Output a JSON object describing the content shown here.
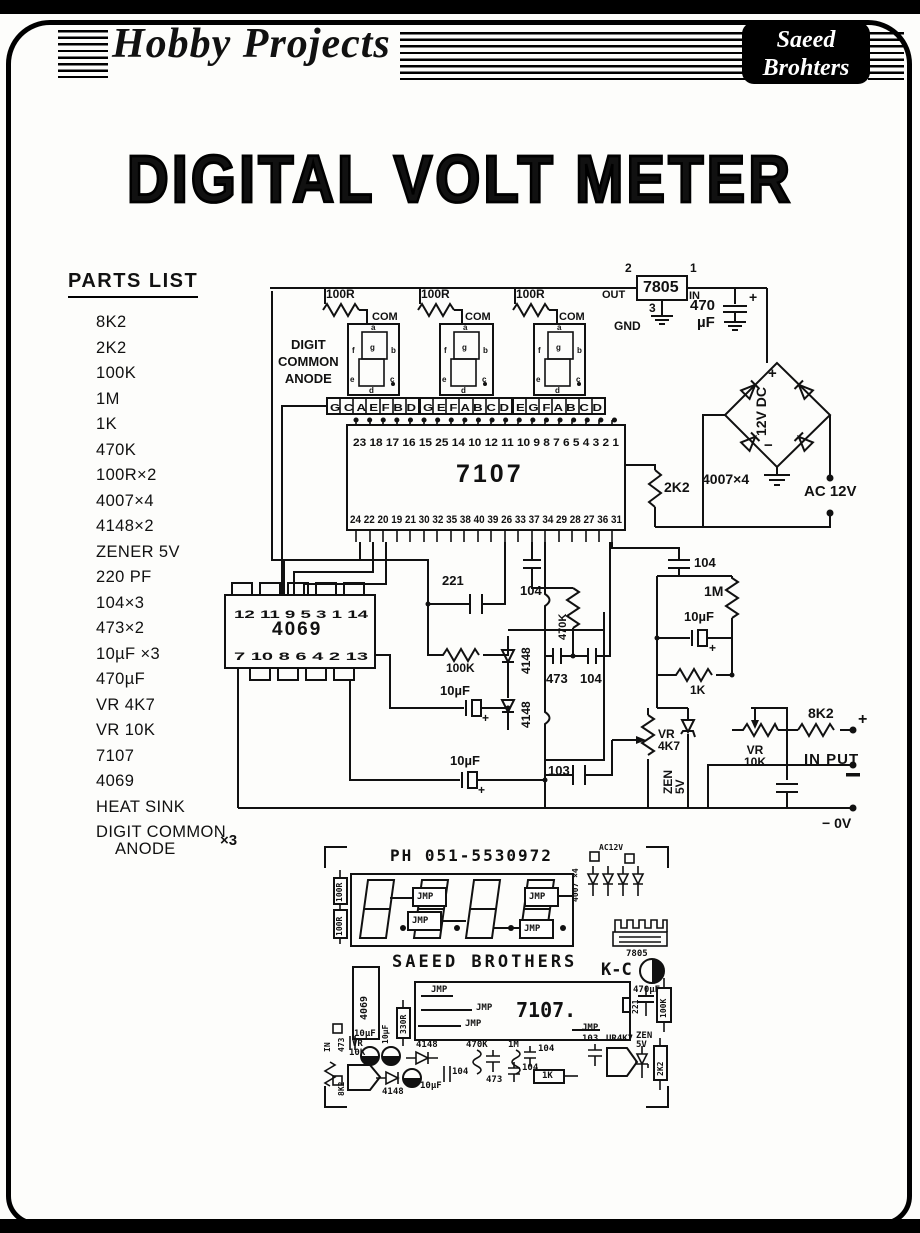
{
  "header": {
    "brand": "Hobby Projects",
    "badge": {
      "line1": "Saeed",
      "line2": "Brohters"
    }
  },
  "title": "DIGITAL VOLT METER",
  "parts_list": {
    "heading": "PARTS LIST",
    "items": [
      "8K2",
      "2K2",
      "100K",
      "1M",
      "1K",
      "470K",
      "100R×2",
      "4007×4",
      "4148×2",
      "ZENER 5V",
      "220 PF",
      "104×3",
      "473×2",
      "10µF ×3",
      "470µF",
      "VR 4K7",
      "VR 10K",
      "7107",
      "4069",
      "HEAT SINK",
      "DIGIT COMMON\n    ANODE"
    ],
    "anode_qty": "×3"
  },
  "schematic": {
    "digit_label": "DIGIT\nCOMMON\nANODE",
    "displays": [
      {
        "resistor": "100R",
        "com": "COM",
        "pins": "G C A E F B D"
      },
      {
        "resistor": "100R",
        "com": "COM",
        "pins": "G E F A B C D"
      },
      {
        "resistor": "100R",
        "com": "COM",
        "pins": "E G F A B C D"
      }
    ],
    "seg": {
      "a": "a",
      "b": "b",
      "c": "c",
      "d": "d",
      "e": "e",
      "f": "f",
      "g": "g"
    },
    "ic7107": {
      "name": "7107",
      "top_pins": "23 18 17 16 15 25 14 10 12 11 10 9 8 7 6 5 4 3 2 1",
      "bottom_pins": "24 22 20 19 21 30 32 35 38 40 39 26 33 37 34 29 28 27 36 31"
    },
    "reg": {
      "name": "7805",
      "p1": "1",
      "p2": "2",
      "p3": "3",
      "out": "OUT",
      "in": "IN",
      "gnd": "GND"
    },
    "sup": {
      "c470": "470",
      "uf": "µF",
      "plus": "+",
      "bridge": "4007×4",
      "dc": "12V DC",
      "bplus": "+",
      "bminus": "−",
      "ac": "AC 12V"
    },
    "r2k2": "2K2",
    "ic4069": {
      "name": "4069",
      "top_pins": "12 11 9 5 3 1 14",
      "bottom_pins": "7 10 8 6 4 2 13"
    },
    "c221": "221",
    "r100k": "100K",
    "c10uf": "10µF",
    "d4148": "4148",
    "c104": "104",
    "r470k": "470K",
    "c473": "473",
    "c103": "103",
    "r1m": "1M",
    "r1k": "1K",
    "vr4k7": "VR\n4K7",
    "zen": "ZEN\n5V",
    "vr10k": "VR\n10K",
    "r8k2": "8K2",
    "input": "IN PUT",
    "zero": "− 0V",
    "plus": "+"
  },
  "pcb": {
    "title": "PH 051-5530972",
    "brand": "SAEED BROTHERS",
    "jmp": "JMP",
    "r100r": "100R",
    "d4007": "4007 ×4",
    "ac": "AC12V",
    "reg": "7805",
    "kc": "K-C",
    "c470uf": "470µF",
    "ic4069": "4069",
    "ic7107": "7107.",
    "r330": "330R",
    "c221": "221",
    "r100k": "100K",
    "zen": "ZEN\n5V",
    "r2k2": "2K2",
    "c103": "103",
    "vr4k7": "UR4K7",
    "c104": "104",
    "r1k": "1K",
    "c473": "473",
    "r470k": "470K",
    "r1m": "1M",
    "d4148": "4148",
    "c10uf": "10µF",
    "vr": "VR",
    "v10k": "10K",
    "r8k2": "8K2",
    "in": "IN"
  }
}
